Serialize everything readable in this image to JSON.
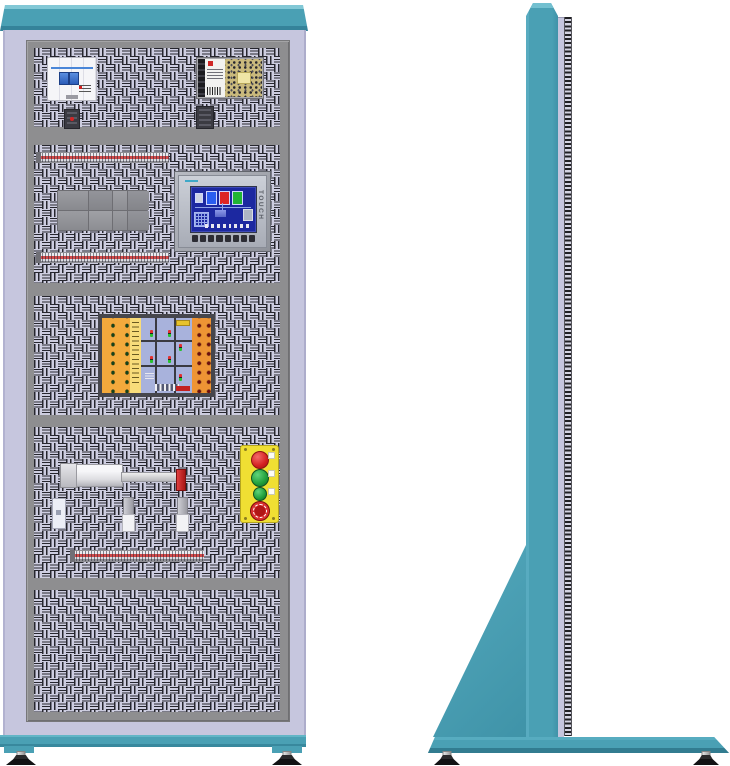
{
  "illustration": {
    "subject": "electrical-training-cabinet",
    "views": [
      "front",
      "side"
    ]
  },
  "palette": {
    "teal": "#4aa0b4",
    "teal_light": "#7cc4d3",
    "teal_dark": "#38889d",
    "lavender": "#c6c6de",
    "frame_gray": "#8e8e90",
    "panel_base": "#cdcde0",
    "perforation": "#26262e"
  },
  "front_view": {
    "sections": 5,
    "circuit_breaker": {
      "poles": 2,
      "toggle_color": "#2f6fd0"
    },
    "power_supply": {
      "pcb_color": "#c9b97c",
      "logo_color": "#cf2828"
    },
    "terminal_rails": {
      "count": 3,
      "stripe_color": "#d24a4a"
    },
    "contactor_group": {
      "blocks": 8
    },
    "hmi_panel": {
      "side_label": "TOUCH",
      "screen_color": "#1c28a0",
      "function_keys": 8,
      "screen_buttons": 8,
      "tank_colors": [
        "#2a5df0",
        "#dd2525",
        "#22b534"
      ]
    },
    "traffic_light_board": {
      "left_leds": {
        "rows": 8,
        "cols": 2,
        "color": "#15431a"
      },
      "right_leds": {
        "rows": 8,
        "cols": 2,
        "color": "#6e0f0f"
      }
    },
    "pneumatic_cylinder": {
      "tip_color": "#c23030"
    },
    "sensors": {
      "count": 2
    },
    "push_button_station": {
      "buttons": [
        "red",
        "green",
        "green",
        "emergency-stop"
      ]
    },
    "leveling_feet": {
      "count": 2
    }
  },
  "side_view": {
    "leveling_feet": {
      "count": 2
    }
  }
}
